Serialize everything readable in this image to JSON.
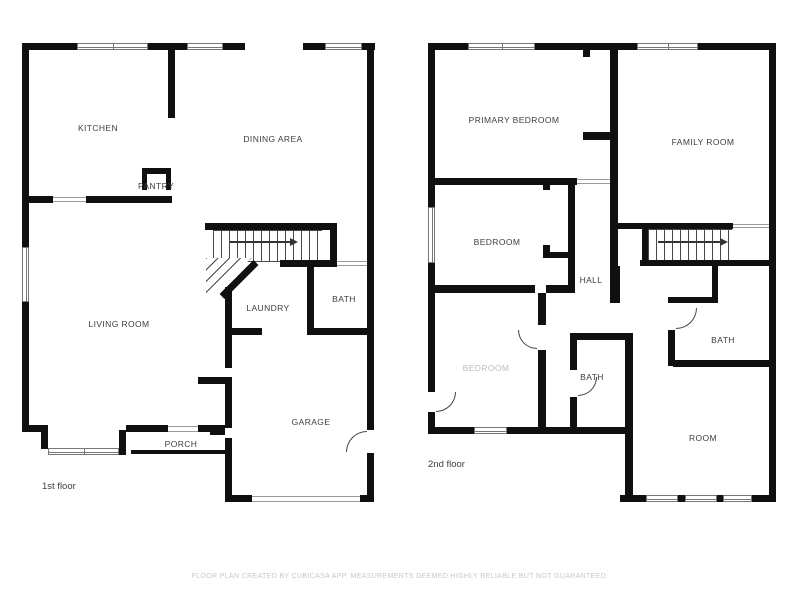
{
  "title": "Floor plan",
  "first_floor": {
    "floor_label": "1st floor",
    "rooms": {
      "kitchen": "KITCHEN",
      "dining": "DINING AREA",
      "pantry": "PANTRY",
      "living": "LIVING ROOM",
      "laundry": "LAUNDRY",
      "bath": "BATH",
      "garage": "GARAGE",
      "porch": "PORCH"
    }
  },
  "second_floor": {
    "floor_label": "2nd floor",
    "rooms": {
      "primary_bedroom": "PRIMARY BEDROOM",
      "family_room": "FAMILY ROOM",
      "bedroom": "BEDROOM",
      "hall": "HALL",
      "bedroom_faded": "BEDROOM",
      "bath_center": "BATH",
      "bath_right": "BATH",
      "room": "ROOM"
    }
  },
  "footer": {
    "disclaimer": "FLOOR PLAN CREATED BY CUBICASA APP. MEASUREMENTS DEEMED HIGHLY RELIABLE BUT NOT GUARANTEED."
  },
  "colors": {
    "wall": "#101010",
    "background": "#ffffff",
    "room_label": "#3e3e3e",
    "window_line": "#777777",
    "disclaimer_text": "#c8c8c8"
  }
}
